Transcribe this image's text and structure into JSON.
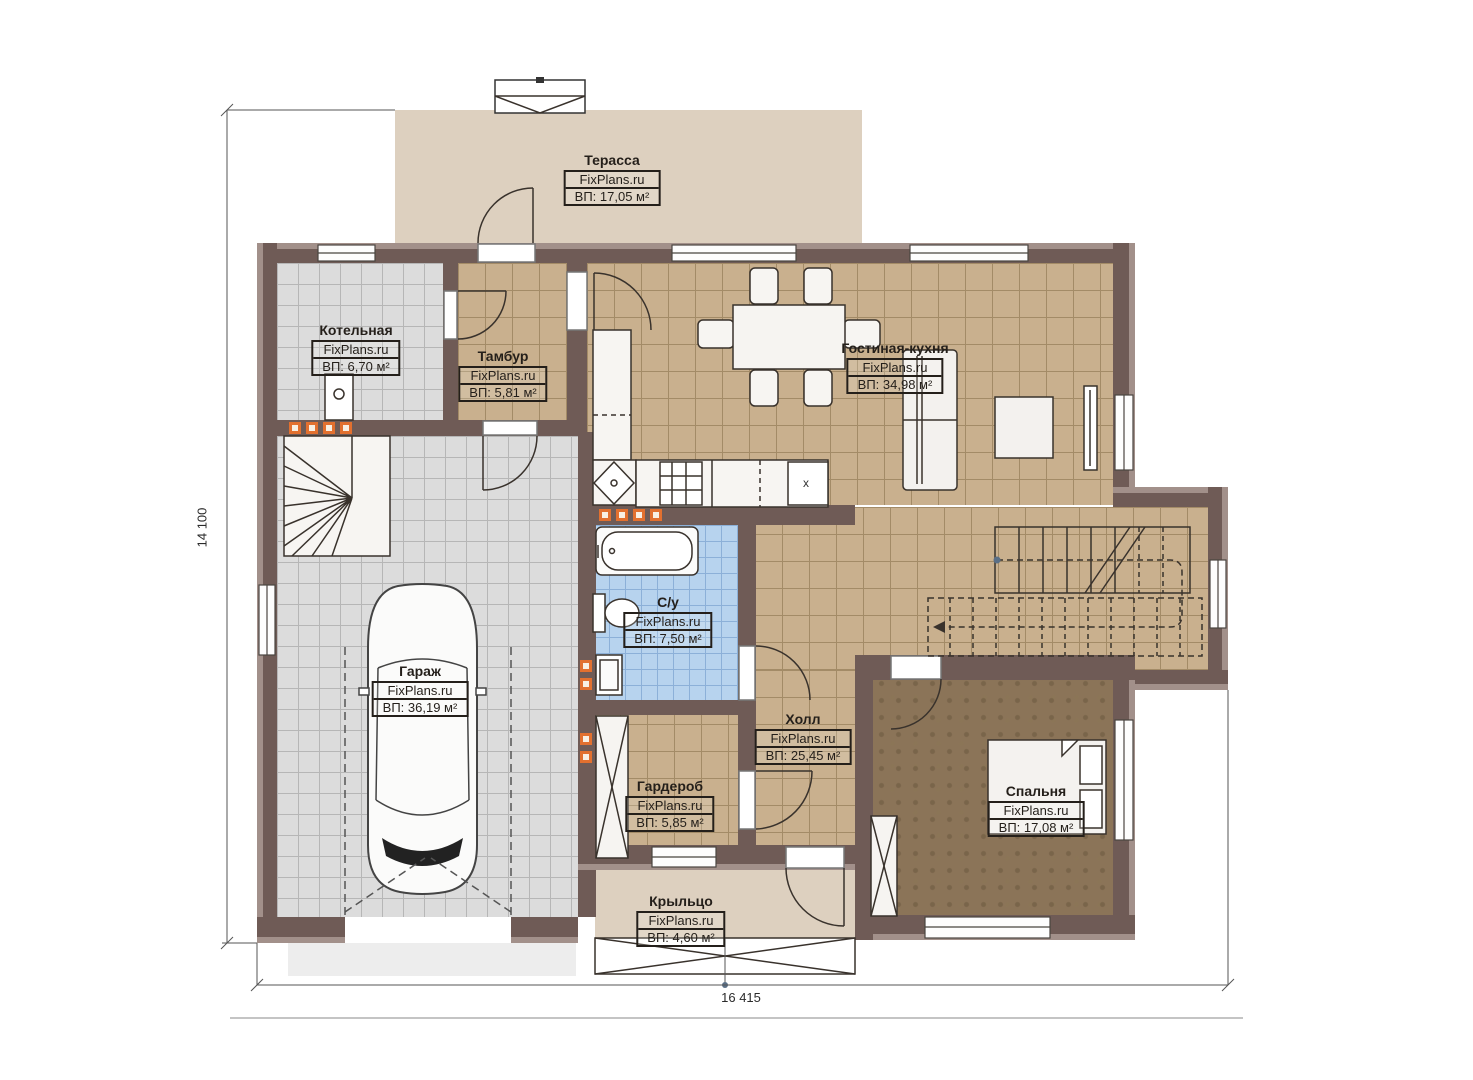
{
  "rooms": [
    {
      "id": "terrace",
      "name": "Терасса",
      "watermark": "FixPlans.ru",
      "area": "ВП: 17,05 м²"
    },
    {
      "id": "boiler",
      "name": "Котельная",
      "watermark": "FixPlans.ru",
      "area": "ВП: 6,70 м²"
    },
    {
      "id": "vestibule",
      "name": "Тамбур",
      "watermark": "FixPlans.ru",
      "area": "ВП: 5,81 м²"
    },
    {
      "id": "living-kitchen",
      "name": "Гостиная-кухня",
      "watermark": "FixPlans.ru",
      "area": "ВП: 34,98 м²"
    },
    {
      "id": "bathroom",
      "name": "С/у",
      "watermark": "FixPlans.ru",
      "area": "ВП: 7,50 м²"
    },
    {
      "id": "garage",
      "name": "Гараж",
      "watermark": "FixPlans.ru",
      "area": "ВП: 36,19 м²"
    },
    {
      "id": "hall",
      "name": "Холл",
      "watermark": "FixPlans.ru",
      "area": "ВП: 25,45 м²"
    },
    {
      "id": "wardrobe",
      "name": "Гардероб",
      "watermark": "FixPlans.ru",
      "area": "ВП: 5,85 м²"
    },
    {
      "id": "bedroom",
      "name": "Спальня",
      "watermark": "FixPlans.ru",
      "area": "ВП: 17,08 м²"
    },
    {
      "id": "porch",
      "name": "Крыльцо",
      "watermark": "FixPlans.ru",
      "area": "ВП: 4,60 м²"
    }
  ],
  "dimensions": {
    "height_mm": "14 100",
    "width_mm": "16 415"
  },
  "annotations": {
    "kitchen_unit_marker": "x"
  },
  "colors": {
    "wall": "#6f5b56",
    "wall_edge": "#a2908a",
    "tile_beige": "#c9b08e",
    "tile_gray": "#dcdcdc",
    "tile_blue": "#b7d3ee",
    "carpet": "#8b7458",
    "terrace": "#ddd0bf",
    "radiator": "#e2702f",
    "line": "#39322c"
  }
}
